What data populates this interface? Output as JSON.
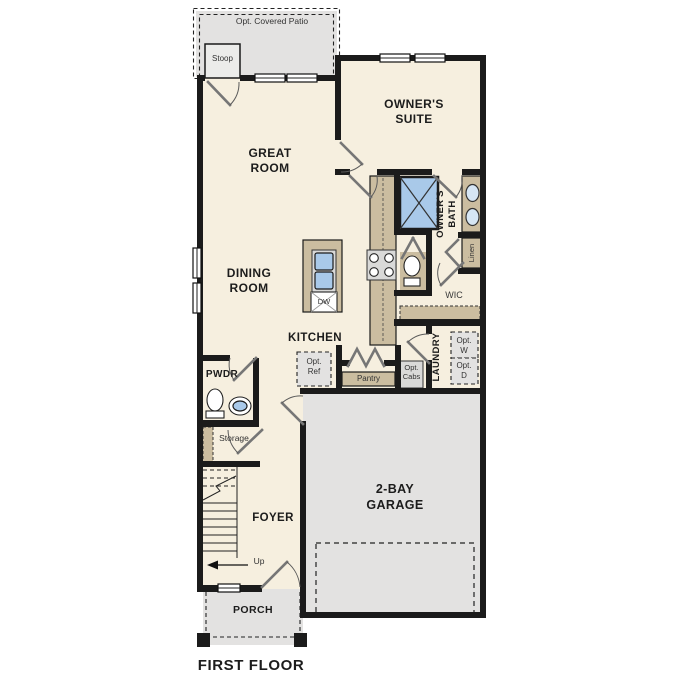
{
  "colors": {
    "wall": "#1b1b1b",
    "room": "#f6efdf",
    "gray": "#e3e2e1",
    "tan": "#cbbda0",
    "blue": "#a9c9e9",
    "fixg": "#d9d9d8",
    "bg": "#ffffff",
    "text": "#1c1c1c"
  },
  "plan": {
    "floor_label": "FIRST FLOOR",
    "rooms": {
      "opt_covered_patio": "Opt. Covered Patio",
      "stoop": "Stoop",
      "owners_suite": "OWNER'S SUITE",
      "great_room": "GREAT ROOM",
      "owners_bath": "OWNER'S BATH",
      "linen": "Linen",
      "wic": "WIC",
      "dining_room": "DINING ROOM",
      "kitchen": "KITCHEN",
      "laundry": "LAUNDRY",
      "pwdr": "PWDR",
      "storage": "Storage",
      "foyer": "FOYER",
      "garage": "2-BAY GARAGE",
      "porch": "PORCH"
    },
    "features": {
      "dw": "DW",
      "pantry": "Pantry",
      "opt_ref": "Opt. Ref",
      "opt_cabs": "Opt. Cabs",
      "opt_w": "Opt. W",
      "opt_d": "Opt. D",
      "up": "Up"
    }
  }
}
